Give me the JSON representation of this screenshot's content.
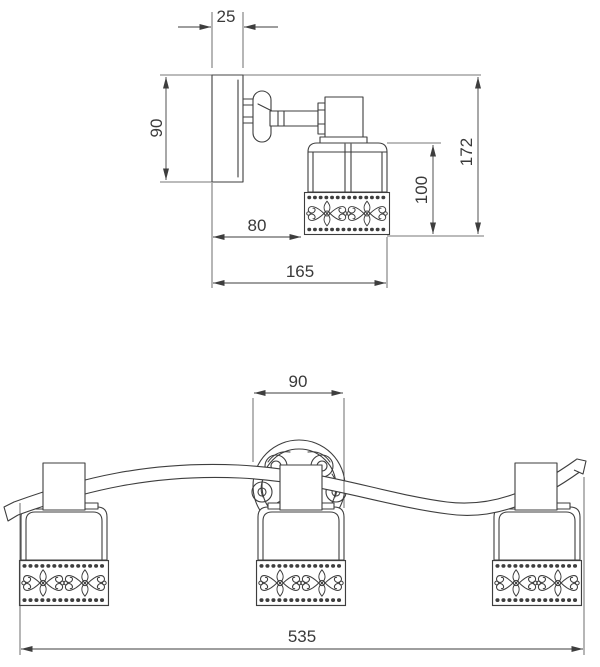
{
  "drawing": {
    "side_view": {
      "dimensions": {
        "plate_depth": "25",
        "plate_height": "90",
        "wall_to_shade": "80",
        "total_depth": "165",
        "shade_height": "100",
        "total_height": "172"
      }
    },
    "front_view": {
      "dimensions": {
        "canopy_diameter": "90",
        "total_width": "535"
      }
    }
  },
  "colors": {
    "line": "#3e3e3e",
    "text": "#3a3a3a",
    "background": "#ffffff"
  }
}
